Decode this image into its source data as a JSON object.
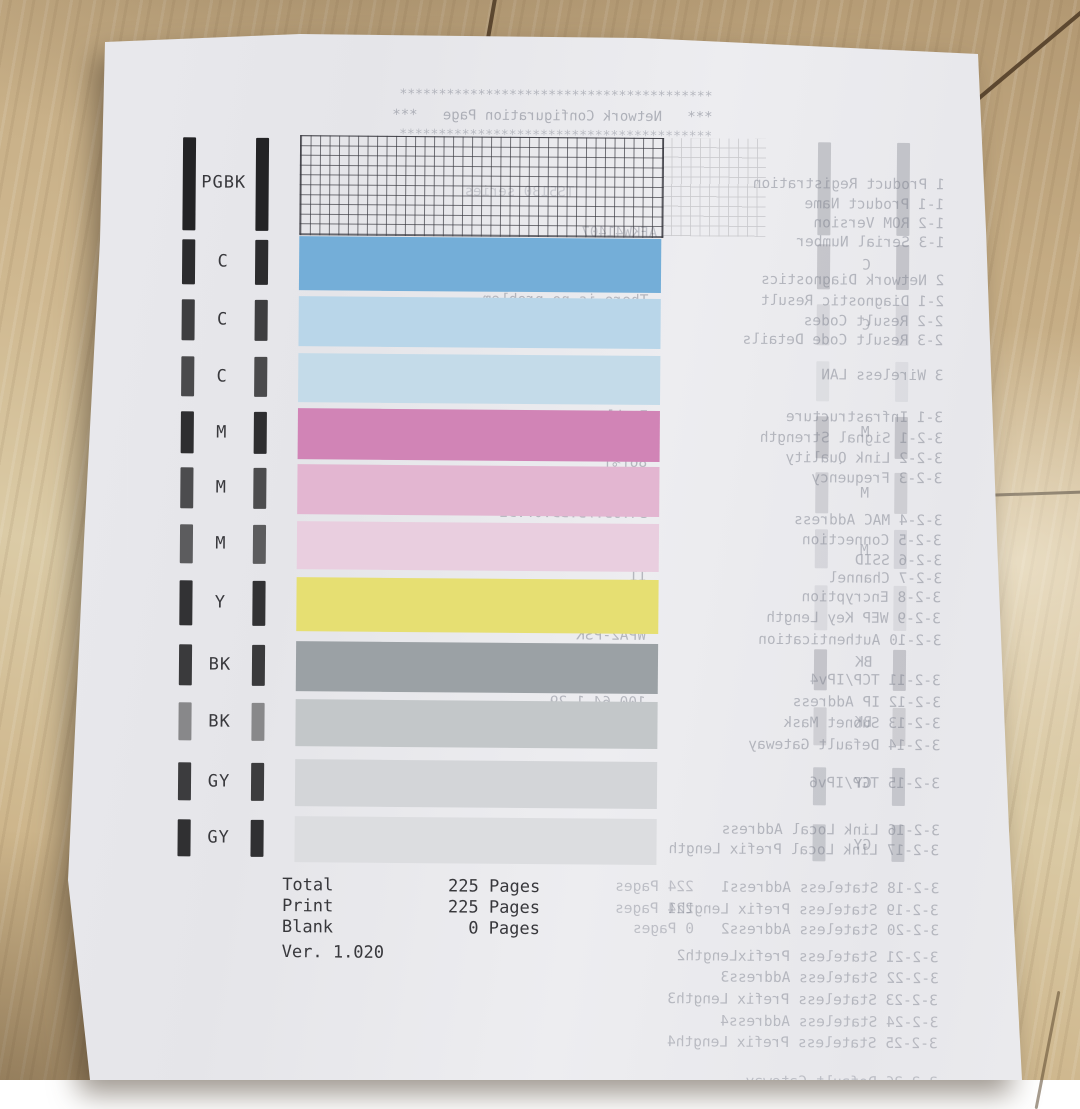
{
  "scene": {
    "description": "Canon nozzle check test print on a wooden floor with mirrored bleed-through of a Network Configuration Page",
    "floor_base": "#c9b08a",
    "floor_seam": "#5d4830",
    "paper_color": "#e9e9ec",
    "ink_text_color": "#3b3b3f",
    "bleed_text_color": "#7e828e"
  },
  "front": {
    "rows": [
      {
        "label": "PGBK",
        "y": 134,
        "h": 98,
        "type": "grid",
        "fill": "",
        "bar_color": "#232325",
        "bleed": 0.32
      },
      {
        "label": "C",
        "y": 235,
        "h": 54,
        "fill": "#74aed8",
        "bar_color": "#2c2c2e",
        "bleed": 0.3
      },
      {
        "label": "C",
        "y": 295,
        "h": 50,
        "fill": "#b9d6e9",
        "bar_color": "#3e3e40",
        "bleed": 0.16
      },
      {
        "label": "C",
        "y": 352,
        "h": 49,
        "fill": "#c4dbe9",
        "bar_color": "#4a4a4c",
        "bleed": 0.1
      },
      {
        "label": "M",
        "y": 407,
        "h": 51,
        "fill": "#d184b6",
        "bar_color": "#2e2e30",
        "bleed": 0.3
      },
      {
        "label": "M",
        "y": 463,
        "h": 50,
        "fill": "#e3b6d1",
        "bar_color": "#4c4c4e",
        "bleed": 0.22
      },
      {
        "label": "M",
        "y": 520,
        "h": 48,
        "fill": "#e9cedf",
        "bar_color": "#5c5c5e",
        "bleed": 0.16
      },
      {
        "label": "Y",
        "y": 576,
        "h": 54,
        "fill": "#e6df72",
        "bar_color": "#323234",
        "bleed": 0.12
      },
      {
        "label": "BK",
        "y": 640,
        "h": 50,
        "fill": "#9ba1a5",
        "bar_color": "#3a3a3c",
        "bleed": 0.3
      },
      {
        "label": "BK",
        "y": 698,
        "h": 47,
        "fill": "#c3c7c9",
        "bar_color": "#88888a",
        "bleed": 0.22
      },
      {
        "label": "GY",
        "y": 758,
        "h": 47,
        "fill": "#d3d5d8",
        "bar_color": "#3c3c3e",
        "bleed": 0.28
      },
      {
        "label": "GY",
        "y": 815,
        "h": 46,
        "fill": "#dcdde0",
        "bar_color": "#303032",
        "bleed": 0.28
      }
    ],
    "stats": {
      "lines": [
        {
          "label": "Total",
          "value": "225 Pages"
        },
        {
          "label": "Print",
          "value": "225 Pages"
        },
        {
          "label": "Blank",
          "value": "0 Pages"
        }
      ],
      "version": "Ver. 1.020"
    }
  },
  "bleed": {
    "lines": [
      {
        "t": "****************************************",
        "r": 712,
        "y": 86,
        "s": 13,
        "o": 0.5
      },
      {
        "t": "***   Network Configuration Page   ***",
        "r": 712,
        "y": 106,
        "s": 14,
        "o": 0.55
      },
      {
        "t": "****************************************",
        "r": 712,
        "y": 126,
        "s": 13,
        "o": 0.45
      },
      {
        "t": "TS5130 series",
        "r": 575,
        "y": 182,
        "s": 14,
        "o": 0.3
      },
      {
        "t": "AFKW41407",
        "r": 658,
        "y": 222,
        "s": 14,
        "o": 0.42
      },
      {
        "t": "1 Product Registration",
        "r": 945,
        "y": 172,
        "s": 14.5,
        "o": 0.5
      },
      {
        "t": "1-1 Product Name",
        "r": 945,
        "y": 192,
        "s": 14.5,
        "o": 0.5
      },
      {
        "t": "1-2 ROM Version",
        "r": 945,
        "y": 211,
        "s": 14.5,
        "o": 0.5
      },
      {
        "t": "1-3 Serial Number",
        "r": 945,
        "y": 230,
        "s": 14.5,
        "o": 0.5
      },
      {
        "t": "2 Network Diagnostics",
        "r": 945,
        "y": 268,
        "s": 14.5,
        "o": 0.5
      },
      {
        "t": "2-1 Diagnostic Result",
        "r": 945,
        "y": 289,
        "s": 14.5,
        "o": 0.5
      },
      {
        "t": "2-2 Result Codes",
        "r": 945,
        "y": 309,
        "s": 14.5,
        "o": 0.5
      },
      {
        "t": "2-3 Result Code Details",
        "r": 945,
        "y": 328,
        "s": 14.5,
        "o": 0.5
      },
      {
        "t": "3 Wireless LAN",
        "r": 945,
        "y": 363,
        "s": 14.5,
        "o": 0.5
      },
      {
        "t": "3-1 Infrastructure",
        "r": 945,
        "y": 405,
        "s": 14.5,
        "o": 0.5
      },
      {
        "t": "3-2-1 Signal Strength",
        "r": 945,
        "y": 426,
        "s": 14.5,
        "o": 0.5
      },
      {
        "t": "3-2-2 Link Quality",
        "r": 945,
        "y": 446,
        "s": 14.5,
        "o": 0.5
      },
      {
        "t": "3-2-3 Frequency",
        "r": 945,
        "y": 466,
        "s": 14.5,
        "o": 0.5
      },
      {
        "t": "3-2-4 MAC Address",
        "r": 945,
        "y": 508,
        "s": 14.5,
        "o": 0.5
      },
      {
        "t": "3-2-5 Connection",
        "r": 945,
        "y": 528,
        "s": 14.5,
        "o": 0.5
      },
      {
        "t": "3-2-6 SSID",
        "r": 945,
        "y": 548,
        "s": 14.5,
        "o": 0.5
      },
      {
        "t": "3-2-7 Channel",
        "r": 945,
        "y": 566,
        "s": 14.5,
        "o": 0.5
      },
      {
        "t": "3-2-8 Encryption",
        "r": 945,
        "y": 585,
        "s": 14.5,
        "o": 0.5
      },
      {
        "t": "3-2-9 WEP Key Length",
        "r": 945,
        "y": 606,
        "s": 14.5,
        "o": 0.5
      },
      {
        "t": "3-2-10 Authentication",
        "r": 945,
        "y": 628,
        "s": 14.5,
        "o": 0.5
      },
      {
        "t": "3-2-11 TCP/IPv4",
        "r": 945,
        "y": 668,
        "s": 14.5,
        "o": 0.5
      },
      {
        "t": "3-2-12 IP Address",
        "r": 945,
        "y": 690,
        "s": 14.5,
        "o": 0.5
      },
      {
        "t": "3-2-13 Subnet Mask",
        "r": 945,
        "y": 711,
        "s": 14.5,
        "o": 0.5
      },
      {
        "t": "3-2-14 Default Gateway",
        "r": 945,
        "y": 733,
        "s": 14.5,
        "o": 0.5
      },
      {
        "t": "3-2-15 TCP/IPv6",
        "r": 945,
        "y": 771,
        "s": 14.5,
        "o": 0.5
      },
      {
        "t": "3-2-16 Link Local Address",
        "r": 945,
        "y": 818,
        "s": 14.5,
        "o": 0.5
      },
      {
        "t": "3-2-17 Link Local Prefix Length",
        "r": 945,
        "y": 838,
        "s": 14.5,
        "o": 0.5
      },
      {
        "t": "3-2-18 Stateless Address1",
        "r": 945,
        "y": 876,
        "s": 14.5,
        "o": 0.48
      },
      {
        "t": "3-2-19 Stateless Prefix Length1",
        "r": 945,
        "y": 898,
        "s": 14.5,
        "o": 0.48
      },
      {
        "t": "3-2-20 Stateless Address2",
        "r": 945,
        "y": 918,
        "s": 14.5,
        "o": 0.48
      },
      {
        "t": "3-2-21 Stateless PrefixLength2",
        "r": 945,
        "y": 945,
        "s": 14.5,
        "o": 0.48
      },
      {
        "t": "3-2-22 Stateless Address3",
        "r": 945,
        "y": 966,
        "s": 14.5,
        "o": 0.48
      },
      {
        "t": "3-2-23 Stateless Prefix Length3",
        "r": 945,
        "y": 988,
        "s": 14.5,
        "o": 0.48
      },
      {
        "t": "3-2-24 Stateless Address4",
        "r": 945,
        "y": 1010,
        "s": 14.5,
        "o": 0.45
      },
      {
        "t": "3-2-25 Stateless Prefix Length4",
        "r": 945,
        "y": 1031,
        "s": 14.5,
        "o": 0.45
      },
      {
        "t": "3-2-26 Default Gateway",
        "r": 945,
        "y": 1070,
        "s": 14.5,
        "o": 0.4
      },
      {
        "t": "There is no problem.",
        "r": 650,
        "y": 290,
        "s": 14.5,
        "o": 0.5
      },
      {
        "t": "c-0",
        "r": 650,
        "y": 310,
        "s": 14.5,
        "o": 0.5
      },
      {
        "t": "http://canon.com/ijnwt",
        "r": 650,
        "y": 330,
        "s": 14.5,
        "o": 0.5
      },
      {
        "t": "Enable",
        "r": 650,
        "y": 370,
        "s": 14.5,
        "o": 0.5
      },
      {
        "t": "Enable",
        "r": 650,
        "y": 406,
        "s": 14.5,
        "o": 0.55
      },
      {
        "t": "80[%]",
        "r": 650,
        "y": 428,
        "s": 14.5,
        "o": 0.55
      },
      {
        "t": "86[%]",
        "r": 650,
        "y": 452,
        "s": 14.5,
        "o": 0.5
      },
      {
        "t": "2.4[GHz]",
        "r": 650,
        "y": 468,
        "s": 14.5,
        "o": 0.5
      },
      {
        "t": "34:95:75:BD:07:D2",
        "r": 650,
        "y": 503,
        "s": 14.5,
        "o": 0.5
      },
      {
        "t": "Active",
        "r": 650,
        "y": 526,
        "s": 14.5,
        "o": 0.5
      },
      {
        "t": "9G9VSK10-2.4G",
        "r": 650,
        "y": 546,
        "s": 14.5,
        "o": 0.5
      },
      {
        "t": "11",
        "r": 650,
        "y": 566,
        "s": 14.5,
        "o": 0.5
      },
      {
        "t": "AES",
        "r": 650,
        "y": 585,
        "s": 14.5,
        "o": 0.5
      },
      {
        "t": "Inactive",
        "r": 650,
        "y": 608,
        "s": 14.5,
        "o": 0.5
      },
      {
        "t": "WPA2-PSK",
        "r": 650,
        "y": 625,
        "s": 14.5,
        "o": 0.5
      },
      {
        "t": "Enable",
        "r": 650,
        "y": 666,
        "s": 14.5,
        "o": 0.5
      },
      {
        "t": "100.64.1.29",
        "r": 650,
        "y": 692,
        "s": 14.5,
        "o": 0.5
      },
      {
        "t": "255.255.252.0",
        "r": 650,
        "y": 712,
        "s": 14.5,
        "o": 0.5
      },
      {
        "t": "100.64.1.1",
        "r": 650,
        "y": 731,
        "s": 14.5,
        "o": 0.5
      },
      {
        "t": "Enable",
        "r": 650,
        "y": 775,
        "s": 14.5,
        "o": 0.48
      },
      {
        "t": "fe80::3691:7bff:feb0:7d2",
        "r": 650,
        "y": 820,
        "s": 14.5,
        "o": 0.48
      },
      {
        "t": "64",
        "r": 650,
        "y": 835,
        "s": 14.5,
        "o": 0.48
      },
      {
        "t": "224 Pages",
        "r": 700,
        "y": 876,
        "s": 14.5,
        "o": 0.42
      },
      {
        "t": "224 Pages",
        "r": 700,
        "y": 898,
        "s": 14.5,
        "o": 0.42
      },
      {
        "t": "0 Pages",
        "r": 700,
        "y": 918,
        "s": 14.5,
        "o": 0.42
      },
      {
        "t": "C",
        "r": 872,
        "y": 253,
        "s": 14.5,
        "o": 0.5
      },
      {
        "t": "C",
        "r": 872,
        "y": 313,
        "s": 14.5,
        "o": 0.45
      },
      {
        "t": "M",
        "r": 872,
        "y": 420,
        "s": 14.5,
        "o": 0.5
      },
      {
        "t": "M",
        "r": 872,
        "y": 481,
        "s": 14.5,
        "o": 0.5
      },
      {
        "t": "M",
        "r": 872,
        "y": 538,
        "s": 14.5,
        "o": 0.45
      },
      {
        "t": "BK",
        "r": 876,
        "y": 650,
        "s": 14.5,
        "o": 0.5
      },
      {
        "t": "BK",
        "r": 876,
        "y": 710,
        "s": 14.5,
        "o": 0.45
      },
      {
        "t": "GY",
        "r": 876,
        "y": 771,
        "s": 14.5,
        "o": 0.5
      },
      {
        "t": "GY",
        "r": 876,
        "y": 833,
        "s": 14.5,
        "o": 0.5
      }
    ]
  }
}
